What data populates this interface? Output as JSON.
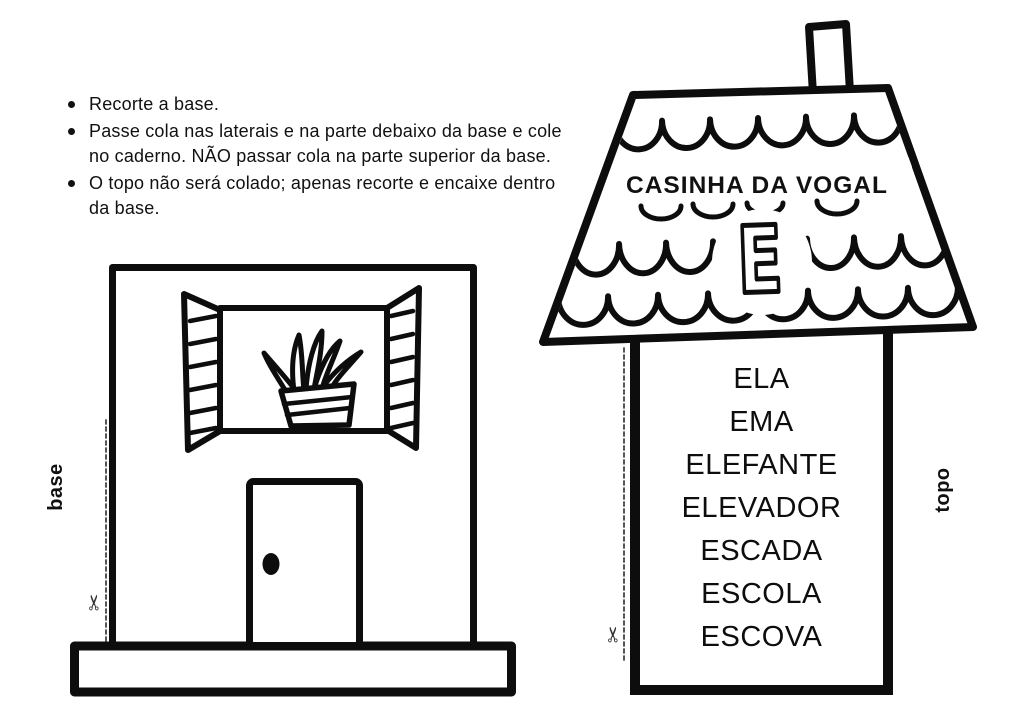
{
  "instructions": {
    "items": [
      "Recorte a base.",
      "Passe cola nas laterais e na parte debaixo da base e cole no caderno. NÃO passar cola na parte superior da base.",
      "O topo não será colado; apenas recorte e encaixe dentro da base."
    ]
  },
  "base_figure": {
    "label": "base"
  },
  "topo_figure": {
    "label": "topo",
    "roof_title": "CASINHA DA VOGAL",
    "vowel": "E",
    "words": [
      "ELA",
      "EMA",
      "ELEFANTE",
      "ELEVADOR",
      "ESCADA",
      "ESCOLA",
      "ESCOVA"
    ]
  },
  "icons": {
    "scissors_glyph": "✂"
  },
  "colors": {
    "ink": "#0d0d0d",
    "paper": "#ffffff"
  }
}
